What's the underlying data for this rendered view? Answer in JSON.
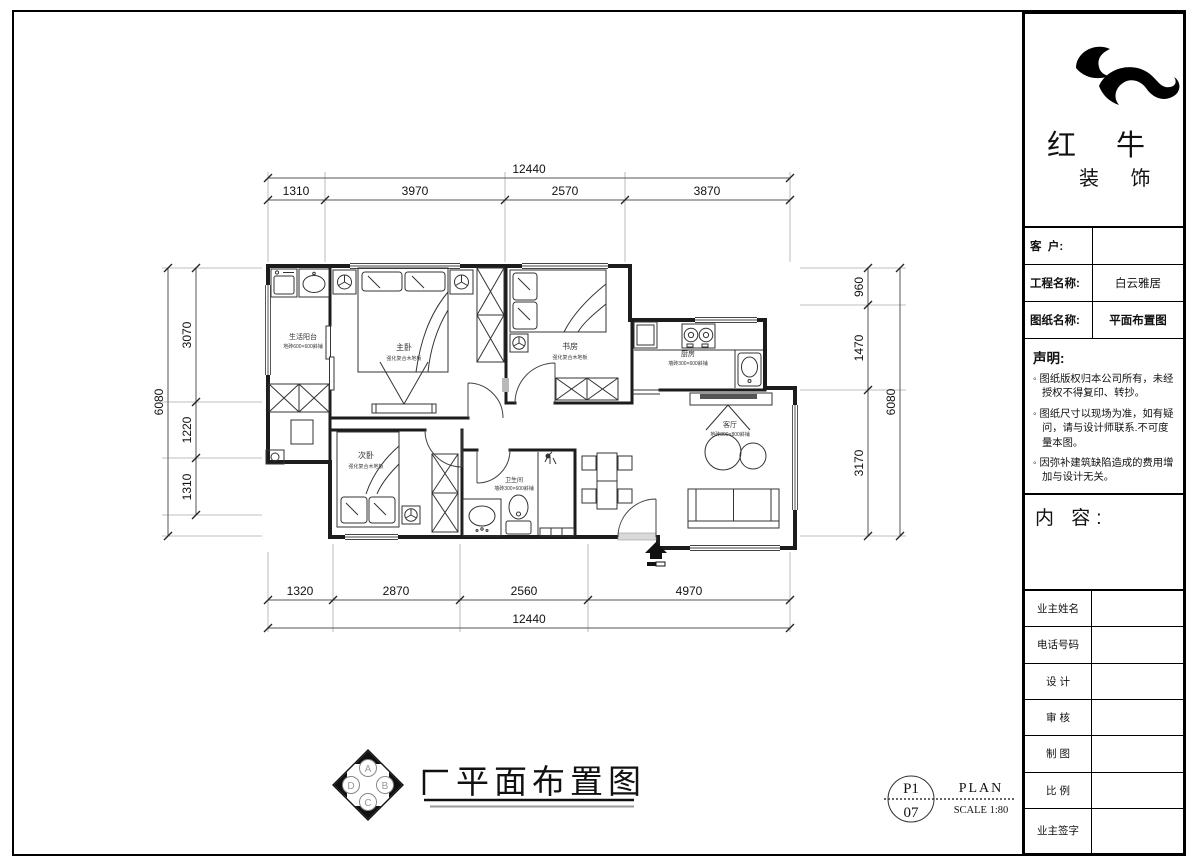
{
  "title_block": {
    "brand_line1": "红 牛",
    "brand_line2": "装 饰",
    "customer_label": "客  户:",
    "customer_value": "",
    "project_label": "工程名称:",
    "project_value": "白云雅居",
    "drawing_label": "图纸名称:",
    "drawing_value": "平面布置图",
    "statement_title": "声明:",
    "statements": [
      "◦ 图纸版权归本公司所有，未经授权不得复印、转抄。",
      "◦ 图纸尺寸以现场为准，如有疑问，请与设计师联系.不可度量本图。",
      "◦ 因弥补建筑缺陷造成的费用增加与设计无关。"
    ],
    "content_label": "内 容:",
    "table_rows": [
      "业主姓名",
      "电话号码",
      "设 计",
      "审 核",
      "制 图",
      "比 例",
      "业主签字"
    ]
  },
  "plan": {
    "rooms": {
      "balcony": {
        "name": "生活阳台",
        "floor": "地砖600×600斜铺"
      },
      "master": {
        "name": "主卧",
        "floor": "强化复合木地板"
      },
      "study": {
        "name": "书房",
        "floor": "强化复合木地板"
      },
      "kitchen": {
        "name": "厨房",
        "floor": "墙砖300×600斜铺"
      },
      "living": {
        "name": "客厅",
        "floor": "地砖800×800斜铺"
      },
      "second": {
        "name": "次卧",
        "floor": "强化复合木地板"
      },
      "bath": {
        "name": "卫生间",
        "floor": "墙砖300×600斜铺"
      }
    }
  },
  "dims": {
    "top": {
      "total": "12440",
      "segments": [
        "1310",
        "3970",
        "2570",
        "3870"
      ]
    },
    "bottom": {
      "total": "12440",
      "segments": [
        "1320",
        "2870",
        "2560",
        "4970"
      ]
    },
    "left": {
      "total": "6080",
      "segments": [
        "3070",
        "1220",
        "1310"
      ]
    },
    "right": {
      "total": "6080",
      "segments": [
        "960",
        "1470",
        "3170"
      ]
    }
  },
  "footer": {
    "compass": [
      "A",
      "B",
      "C",
      "D"
    ],
    "title": "平面布置图",
    "sheet_no_top": "P1",
    "sheet_no_bottom": "07",
    "plan_label": "PLAN",
    "scale_label": "SCALE 1:80"
  },
  "colors": {
    "line": "#1c1c1c",
    "dim": "#555555",
    "ext": "#999999",
    "accent": "#000000"
  }
}
